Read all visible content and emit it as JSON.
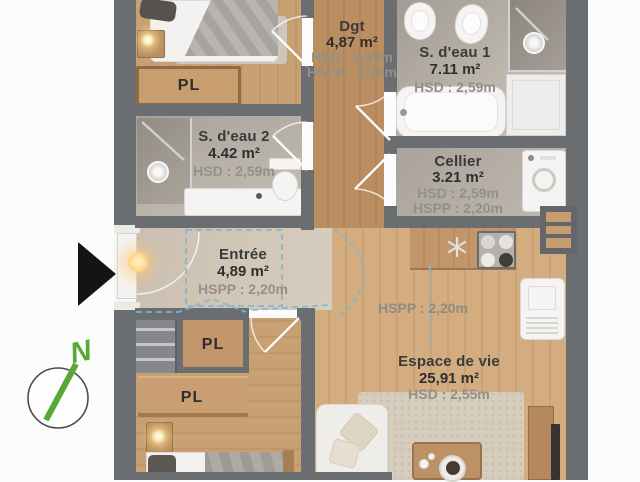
{
  "plan": {
    "compass": {
      "north_label": "N"
    },
    "closets": {
      "label": "PL"
    },
    "annotations": {
      "ceiling": "HSPP : 2,20m"
    },
    "rooms": [
      {
        "key": "dgt",
        "name": "Dgt",
        "area": "4,87 m²",
        "dims": [
          "HSD : 2,59m",
          "HSPP : 2,20m"
        ]
      },
      {
        "key": "sdeau1",
        "name": "S. d'eau 1",
        "area": "7.11 m²",
        "dims": [
          "HSD : 2,59m"
        ]
      },
      {
        "key": "sdeau2",
        "name": "S. d'eau 2",
        "area": "4.42 m²",
        "dims": [
          "HSD : 2,59m"
        ]
      },
      {
        "key": "cellier",
        "name": "Cellier",
        "area": "3.21 m²",
        "dims": [
          "HSD : 2,59m",
          "HSPP : 2,20m"
        ]
      },
      {
        "key": "entree",
        "name": "Entrée",
        "area": "4,89 m²",
        "dims": [
          "HSPP : 2,20m"
        ]
      },
      {
        "key": "espace",
        "name": "Espace de vie",
        "area": "25,91 m²",
        "dims": [
          "HSD : 2,55m"
        ]
      }
    ],
    "colors": {
      "wall": "#6b6e71",
      "wood_floor": "#c79d6e",
      "tile_floor": "#b3aca4",
      "entry_floor": "#cec3b5",
      "dash_accent": "#7fb6cf",
      "compass_green": "#58a837"
    }
  }
}
